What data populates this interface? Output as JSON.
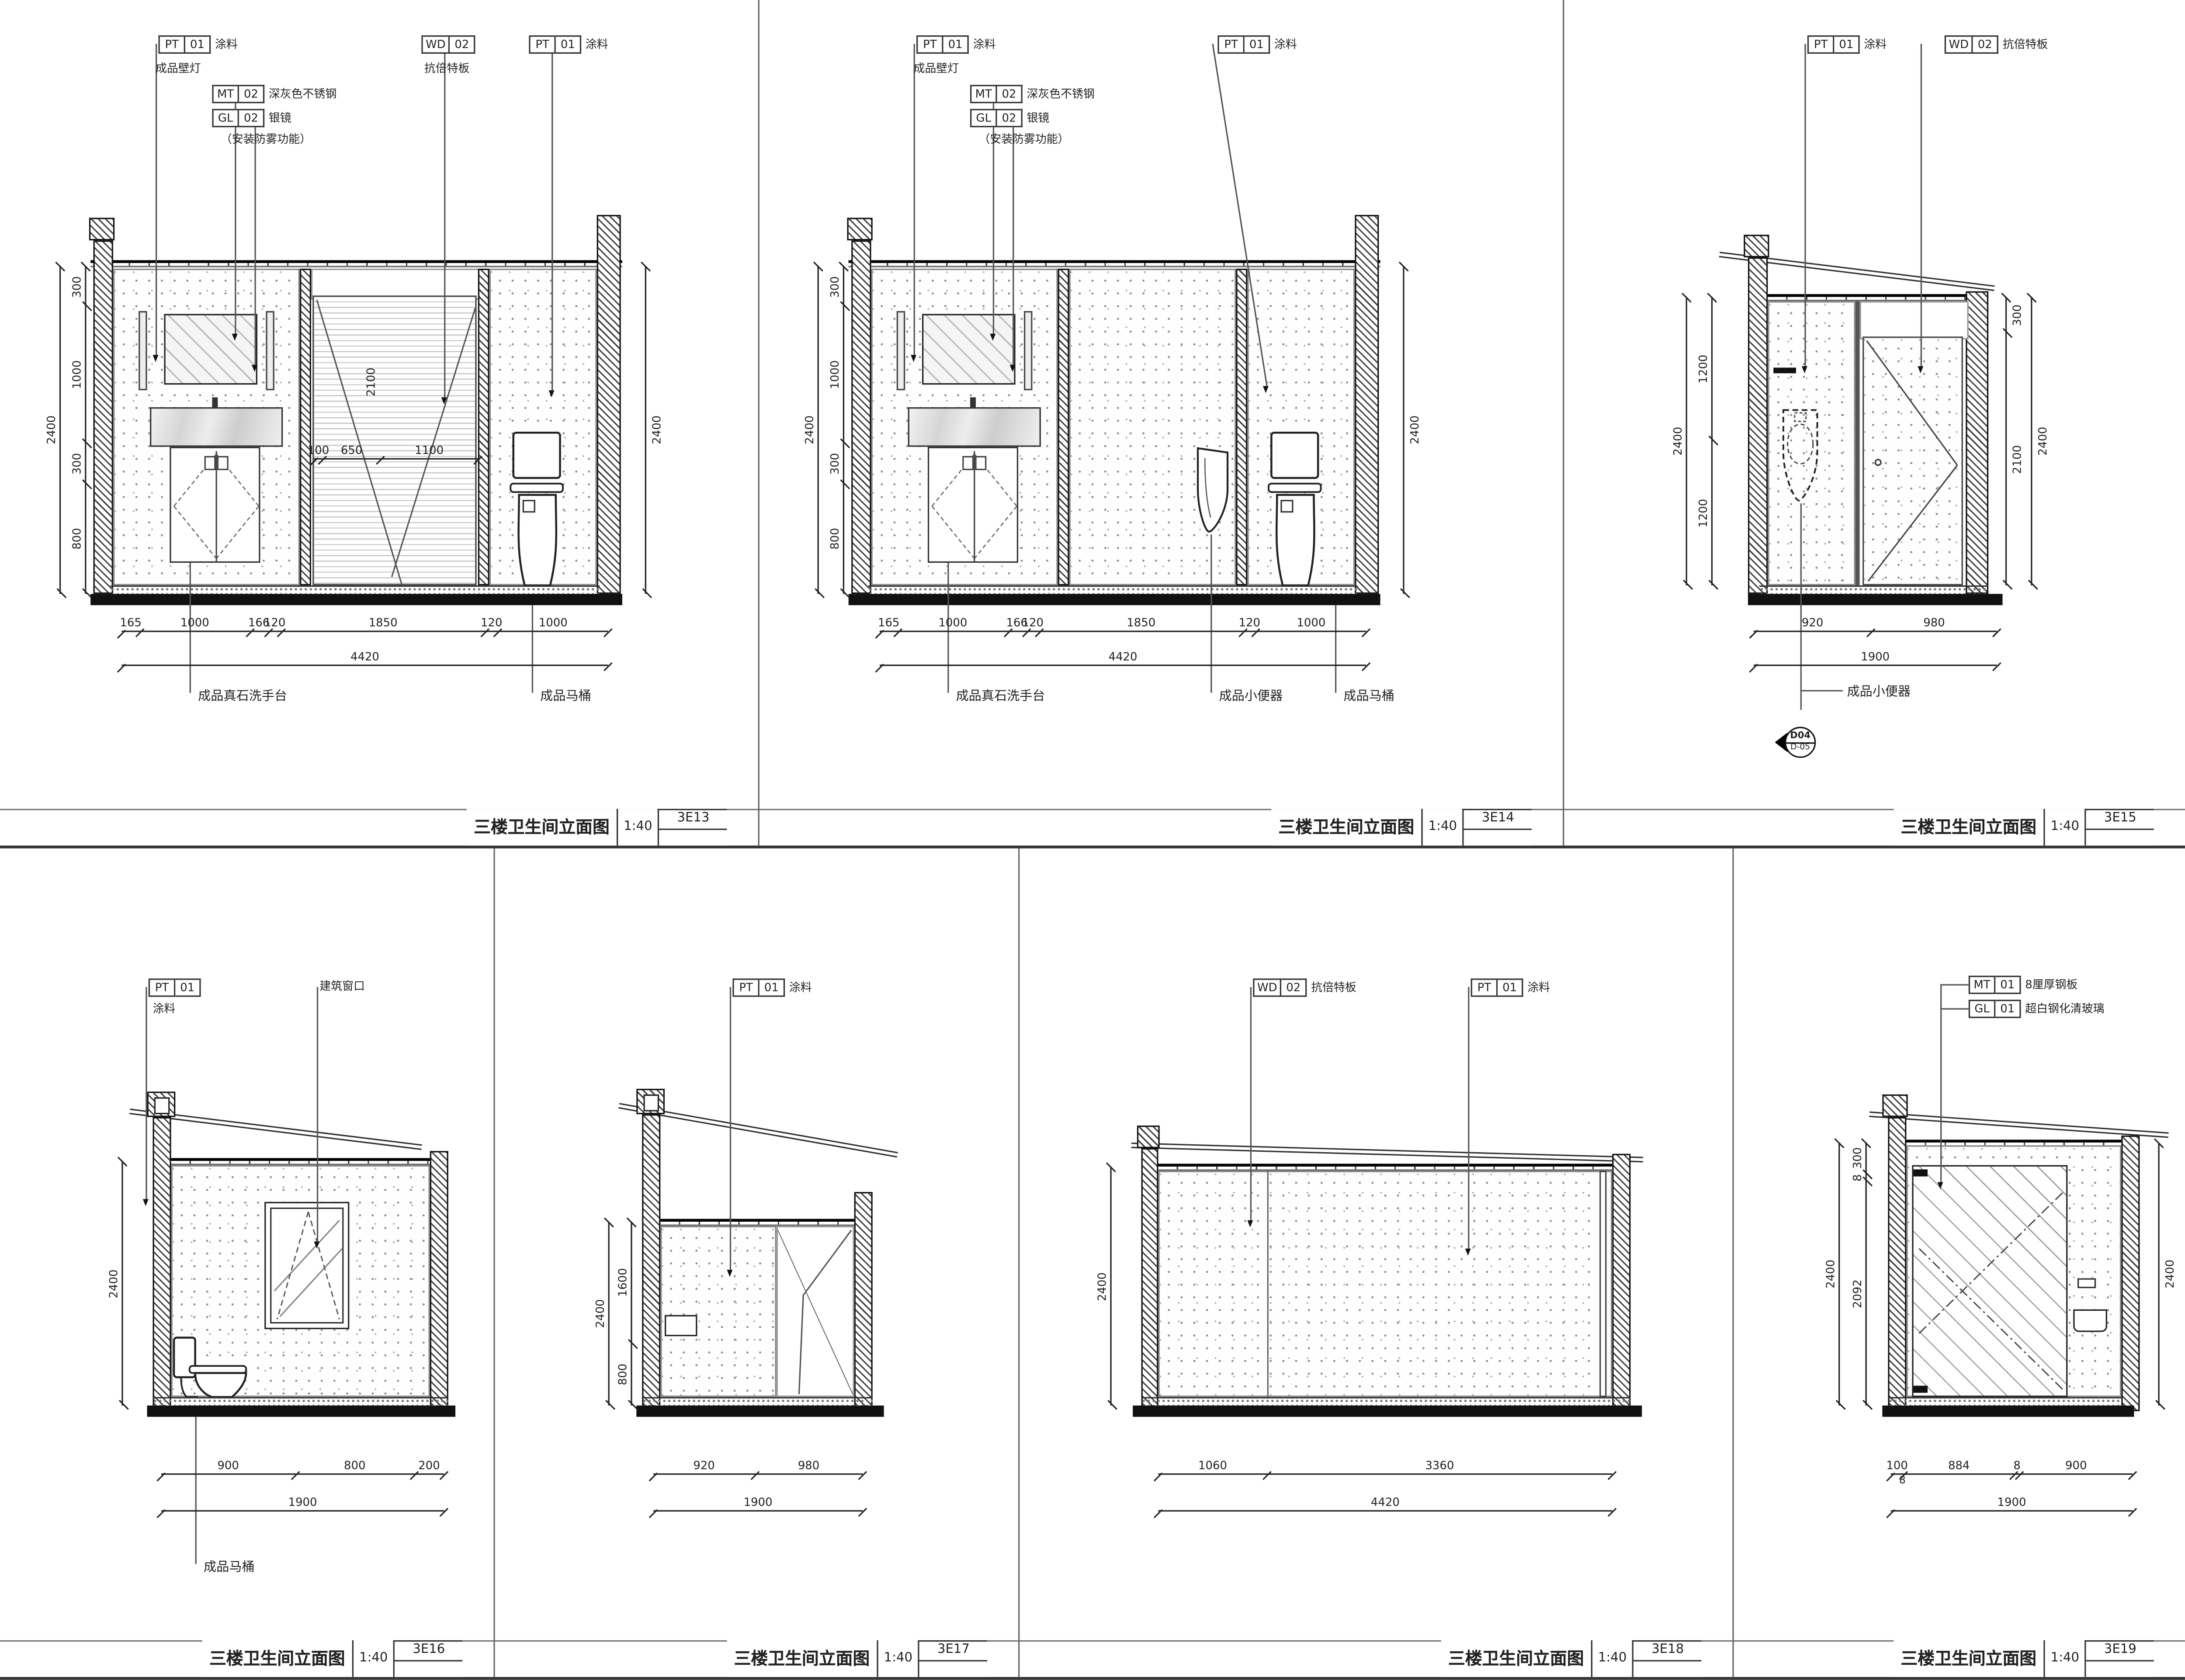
{
  "sheet_title": "三楼卫生间立面图",
  "p1": {
    "title": "三楼卫生间立面图",
    "scale": "1:40",
    "no": "3E13",
    "tag_pt_top": {
      "code": "PT",
      "num": "01",
      "name": "涂料"
    },
    "lamp": "成品壁灯",
    "tag_mt": {
      "code": "MT",
      "num": "02",
      "name": "深灰色不锈钢"
    },
    "tag_gl": {
      "code": "GL",
      "num": "02",
      "name": "银镜"
    },
    "gl_note": "（安装防雾功能）",
    "tag_wd": {
      "code": "WD",
      "num": "02",
      "name": "抗倍特板"
    },
    "tag_pt_right": {
      "code": "PT",
      "num": "01",
      "name": "涂料"
    },
    "dim_left_total": "2400",
    "dim_left": [
      "300",
      "1000",
      "300",
      "800"
    ],
    "dim_right_total": "2400",
    "door_dims": [
      "100",
      "650",
      "1100"
    ],
    "door_h": "2100",
    "dim_bottom": [
      "165",
      "1000",
      "166",
      "120",
      "1850",
      "120",
      "1000"
    ],
    "dim_total": "4420",
    "lbl_sink": "成品真石洗手台",
    "lbl_toilet": "成品马桶"
  },
  "p2": {
    "title": "三楼卫生间立面图",
    "scale": "1:40",
    "no": "3E14",
    "tag_pt_top": {
      "code": "PT",
      "num": "01",
      "name": "涂料"
    },
    "lamp": "成品壁灯",
    "tag_mt": {
      "code": "MT",
      "num": "02",
      "name": "深灰色不锈钢"
    },
    "tag_gl": {
      "code": "GL",
      "num": "02",
      "name": "银镜"
    },
    "gl_note": "（安装防雾功能）",
    "tag_pt_right": {
      "code": "PT",
      "num": "01",
      "name": "涂料"
    },
    "dim_left_total": "2400",
    "dim_left": [
      "300",
      "1000",
      "300",
      "800"
    ],
    "dim_right_total": "2400",
    "dim_bottom": [
      "165",
      "1000",
      "166",
      "120",
      "1850",
      "120",
      "1000"
    ],
    "dim_total": "4420",
    "lbl_sink": "成品真石洗手台",
    "lbl_urinal": "成品小便器",
    "lbl_toilet": "成品马桶"
  },
  "p3": {
    "title": "三楼卫生间立面图",
    "scale": "1:40",
    "no": "3E15",
    "tag_pt": {
      "code": "PT",
      "num": "01",
      "name": "涂料"
    },
    "tag_wd": {
      "code": "WD",
      "num": "02",
      "name": "抗倍特板"
    },
    "dim_left_total": "2400",
    "dim_left": [
      "1200",
      "1200"
    ],
    "dim_right": [
      "300",
      "2100"
    ],
    "dim_right_total": "2400",
    "dim_bottom": [
      "920",
      "980"
    ],
    "dim_total": "1900",
    "lbl_urinal": "成品小便器",
    "marker": {
      "top": "D04",
      "bottom": "D-05"
    }
  },
  "p4": {
    "title": "三楼卫生间立面图",
    "scale": "1:40",
    "no": "3E16",
    "tag_pt": {
      "code": "PT",
      "num": "01",
      "name": "涂料"
    },
    "lbl_window": "建筑窗口",
    "dim_left_total": "2400",
    "dim_bottom": [
      "900",
      "800",
      "200"
    ],
    "dim_total": "1900",
    "lbl_toilet": "成品马桶"
  },
  "p5": {
    "title": "三楼卫生间立面图",
    "scale": "1:40",
    "no": "3E17",
    "tag_pt": {
      "code": "PT",
      "num": "01",
      "name": "涂料"
    },
    "dim_left_total": "2400",
    "dim_left": [
      "1600",
      "800"
    ],
    "dim_bottom": [
      "920",
      "980"
    ],
    "dim_total": "1900"
  },
  "p6": {
    "title": "三楼卫生间立面图",
    "scale": "1:40",
    "no": "3E18",
    "tag_wd": {
      "code": "WD",
      "num": "02",
      "name": "抗倍特板"
    },
    "tag_pt": {
      "code": "PT",
      "num": "01",
      "name": "涂料"
    },
    "dim_left_total": "2400",
    "dim_bottom": [
      "1060",
      "3360"
    ],
    "dim_total": "4420"
  },
  "p7": {
    "title": "三楼卫生间立面图",
    "scale": "1:40",
    "no": "3E19",
    "tag_mt": {
      "code": "MT",
      "num": "01",
      "name": "8厘厚钢板"
    },
    "tag_gl": {
      "code": "GL",
      "num": "01",
      "name": "超白钢化清玻璃"
    },
    "dim_left_total": "2400",
    "dim_left": [
      "300",
      "8",
      "2092"
    ],
    "dim_right_total": "2400",
    "dim_bottom": [
      "100",
      "884",
      "8",
      "900"
    ],
    "dim_tiny": "8",
    "dim_total": "1900"
  }
}
